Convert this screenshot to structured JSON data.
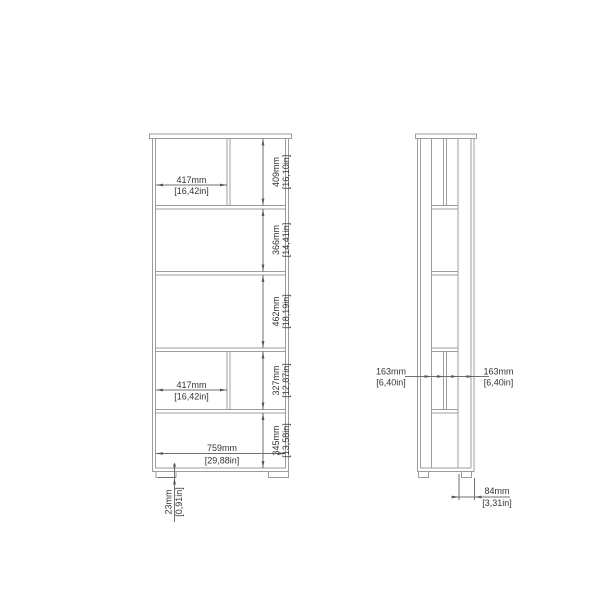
{
  "front_view": {
    "section_dims": [
      {
        "name": "top-section-width",
        "mm": "417mm",
        "inch": "[16,42in]"
      },
      {
        "name": "lower-section-width",
        "mm": "417mm",
        "inch": "[16,42in]"
      },
      {
        "name": "interior-width",
        "mm": "759mm",
        "inch": "[29,88in]"
      }
    ],
    "height_dims": [
      {
        "name": "section-1-height",
        "mm": "409mm",
        "inch": "[16,10in]"
      },
      {
        "name": "section-2-height",
        "mm": "366mm",
        "inch": "[14,41in]"
      },
      {
        "name": "section-3-height",
        "mm": "462mm",
        "inch": "[18,19in]"
      },
      {
        "name": "section-4-height",
        "mm": "327mm",
        "inch": "[12,87in]"
      },
      {
        "name": "section-5-height",
        "mm": "345mm",
        "inch": "[13,58in]"
      }
    ],
    "foot_dim": {
      "name": "foot-height",
      "mm": "23mm",
      "inch": "[0,91in]"
    }
  },
  "side_view": {
    "depth_dims": [
      {
        "name": "back-depth",
        "mm": "163mm",
        "inch": "[6,40in]"
      },
      {
        "name": "front-depth",
        "mm": "163mm",
        "inch": "[6,40in]"
      }
    ],
    "base_dim": {
      "name": "base-depth",
      "mm": "84mm",
      "inch": "[3,31in]"
    }
  },
  "colors": {
    "furniture_line": "#9c9c9c",
    "dimension_line": "#707070",
    "text": "#333333",
    "background": "#ffffff"
  }
}
